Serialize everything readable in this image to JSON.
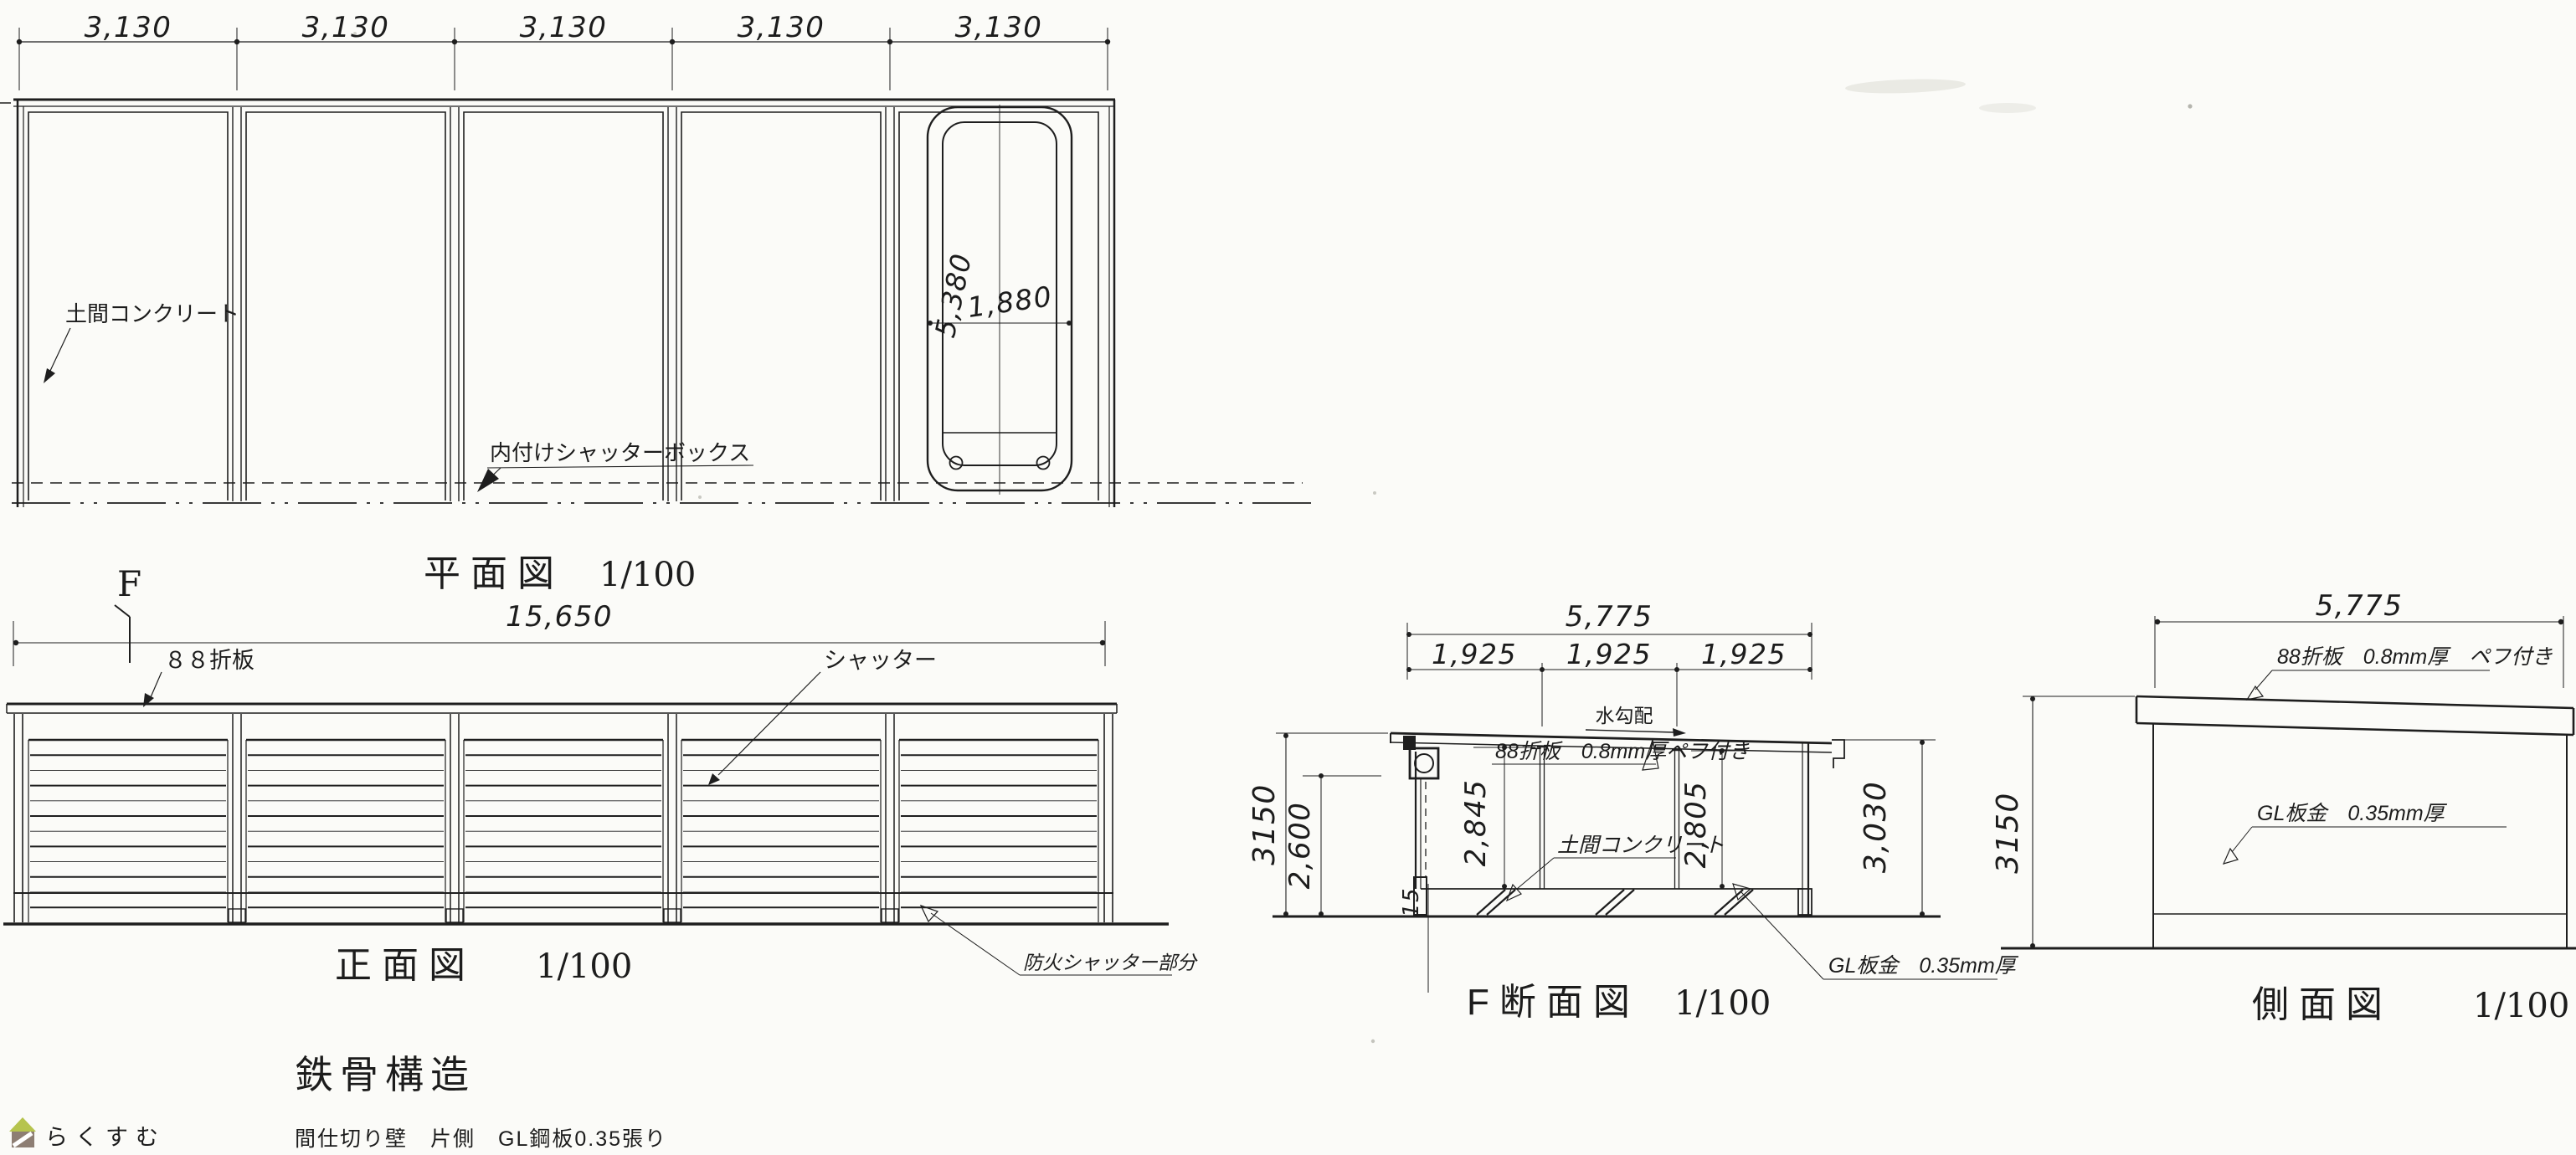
{
  "plan": {
    "title": "平面図",
    "scale": "1/100",
    "section_mark": "F",
    "bay_dims": [
      "3,130",
      "3,130",
      "3,130",
      "3,130",
      "3,130"
    ],
    "slab_label": "土間コンクリート",
    "shutter_box_label": "内付けシャッターボックス",
    "car_length": "5,380",
    "car_width": "1,880"
  },
  "front": {
    "title": "正面図",
    "scale": "1/100",
    "overall_width": "15,650",
    "roof_label": "８８折板",
    "shutter_label": "シャッター",
    "fire_shutter_label": "防火シャッター部分"
  },
  "section": {
    "title": "F断面図",
    "scale": "1/100",
    "overall_width": "5,775",
    "segment_dims": [
      "1,925",
      "1,925",
      "1,925"
    ],
    "slope_label": "水勾配",
    "roof_label": "88折板　0.8mm厚",
    "roof_label2": "ペフ付き",
    "slab_label": "土間コンクリート",
    "wall_label": "GL板金　0.35mm厚",
    "h_outer_left": "3150",
    "h_opening": "2,600",
    "h_inner_left": "2,845",
    "h_inner_right": "2,805",
    "h_outer_right": "3,030",
    "slab_thickness": "15"
  },
  "side": {
    "title": "側面図",
    "scale": "1/100",
    "overall_width": "5,775",
    "roof_label": "88折板　0.8mm厚　ペフ付き",
    "wall_label": "GL板金　0.35mm厚",
    "h_outer": "3150"
  },
  "notes": {
    "structure": "鉄骨構造",
    "partition": "間仕切り壁　片側　GL鋼板0.35張り"
  },
  "watermark": {
    "text": "らくすむ",
    "roof_color": "#b6c44e",
    "body_color": "#8d7e73",
    "text_color": "#9b8c82"
  },
  "colors": {
    "ink": "#1e1e1e",
    "paper": "#fbfbf8"
  }
}
